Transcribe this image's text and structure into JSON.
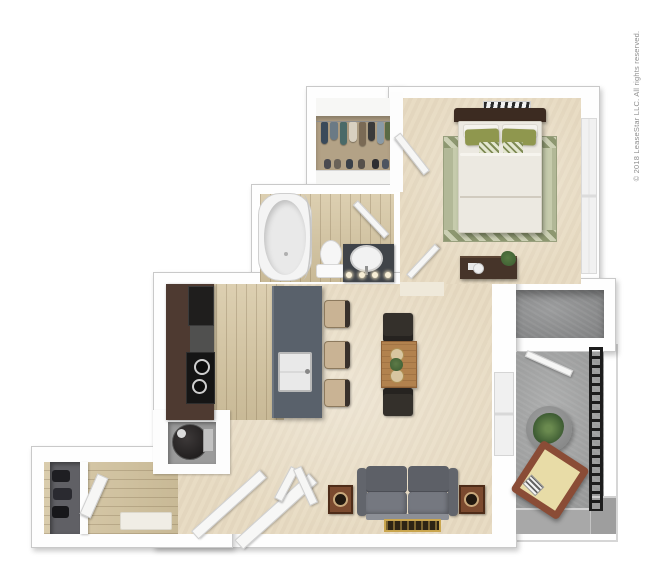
{
  "page": {
    "background_color": "#ffffff",
    "content": "3D apartment floor plan, top-down render, one bedroom one bathroom unit with patio",
    "width_px": 650,
    "height_px": 585
  },
  "watermark": {
    "text": "© 2018 LeaseStar LLC. All rights reserved.",
    "color": "#8f8f8f",
    "font_size_px": 8,
    "rotation_deg": -90,
    "position": "right-edge-vertical-bottom-to-top"
  },
  "palette": {
    "wall": "#fefefe",
    "wall_edge": "#c9c9c9",
    "carpet_beige": "#e8dcc4",
    "wood_floor": "#d5c5a0",
    "concrete_gray": "#a3a4a4",
    "kitchen_cabinet_brown": "#4e3a31",
    "kitchen_appliance_black": "#1f1e1d",
    "island_slate": "#59616b",
    "sofa_gray": "#6a6d74",
    "speaker_brown": "#7b4a2f",
    "dining_table_wood": "#b2824e",
    "bed_duvet": "#ece9e1",
    "pillow_green": "#8f974e",
    "rug_sage": "#b2b897",
    "headboard_desk_brown": "#42302a",
    "vanity_charcoal": "#404449",
    "patio_chair_frame": "#8a4c36",
    "patio_chair_cushion": "#e8dca7",
    "railing_black": "#1d1d1d",
    "plant_green": "#4d6b3b",
    "water_heater_dark": "#2e2b2b",
    "closet_wall_tan": "#b3a286"
  },
  "rooms": [
    {
      "id": "bedroom",
      "floor": "beige carpet",
      "items": [
        "queen bed with white duvet",
        "dark wood headboard",
        "white pillows",
        "green pillows",
        "patterned accent pillows",
        "sage patterned area rug",
        "desk with plant, paper and white stool",
        "striped wall art",
        "window on right wall",
        "swing door"
      ]
    },
    {
      "id": "walk-in-closet",
      "floor": "tan",
      "items": [
        "upper shelf",
        "hanging clothes row",
        "shoe row",
        "leaning closet door"
      ]
    },
    {
      "id": "bathroom",
      "floor": "wood planks",
      "items": [
        "oval bathtub",
        "curved shower rod",
        "toilet",
        "dark vanity with round sink",
        "four vanity lights",
        "swing door"
      ]
    },
    {
      "id": "kitchen",
      "floor": "wood planks",
      "items": [
        "wall cabinet run",
        "black refrigerator",
        "cooktop with two burners",
        "slate island with sink",
        "three bar stools"
      ]
    },
    {
      "id": "living-dining",
      "floor": "beige carpet",
      "items": [
        "wood dining table with two place settings and centerpiece plant",
        "two dark dining chairs",
        "gray sofa",
        "two wood speakers",
        "dark accent mat",
        "sliding glass door to patio"
      ]
    },
    {
      "id": "entry-hall",
      "floor": "wood planks",
      "items": [
        "coat closet with dark clothes",
        "leaning door",
        "open front door",
        "angled walls",
        "light doormat"
      ]
    },
    {
      "id": "utility-closet",
      "floor": "concrete",
      "items": [
        "water heater cylinder with pipe"
      ]
    },
    {
      "id": "storage-closet",
      "floor": "concrete",
      "items": [
        "door to patio"
      ]
    },
    {
      "id": "patio",
      "floor": "concrete",
      "items": [
        "round gray table",
        "potted green plant",
        "angled lounge chair with cushion and striped book",
        "black ladder railing",
        "corner step ledge"
      ]
    }
  ],
  "closet_clothes_colors": [
    "#3a4a5a",
    "#6b7a85",
    "#4a6a68",
    "#d8d0c0",
    "#7a6a55",
    "#3a3a3a",
    "#8a9aa5",
    "#5a6a45"
  ]
}
